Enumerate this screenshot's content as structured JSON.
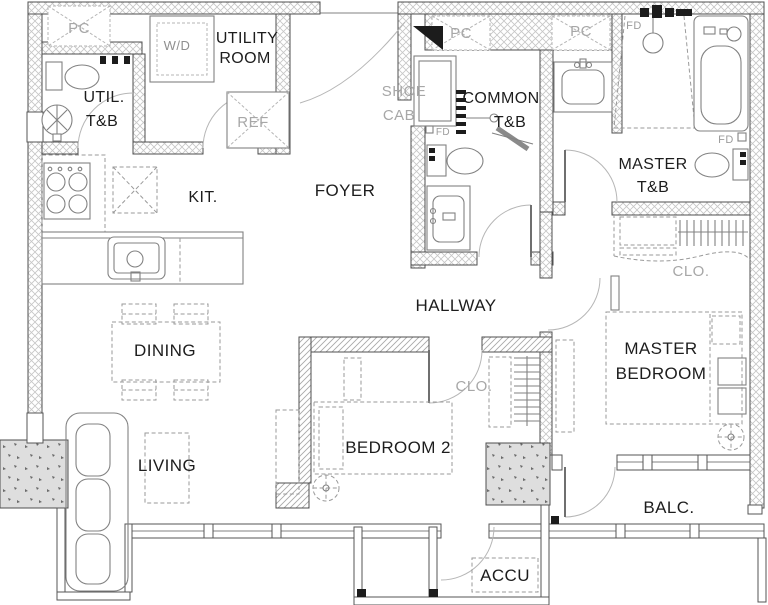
{
  "plan": {
    "rooms": {
      "utility_room": {
        "line1": "UTILITY",
        "line2": "ROOM"
      },
      "util_tb": {
        "line1": "UTIL.",
        "line2": "T&B"
      },
      "kitchen": {
        "label": "KIT."
      },
      "foyer": {
        "label": "FOYER"
      },
      "shoe_cab": {
        "line1": "SHOE",
        "line2": "CAB"
      },
      "common_tb": {
        "line1": "COMMON",
        "line2": "T&B"
      },
      "master_tb": {
        "line1": "MASTER",
        "line2": "T&B"
      },
      "hallway": {
        "label": "HALLWAY"
      },
      "dining": {
        "label": "DINING"
      },
      "living": {
        "label": "LIVING"
      },
      "bedroom2": {
        "label": "BEDROOM 2"
      },
      "master_bedroom": {
        "line1": "MASTER",
        "line2": "BEDROOM"
      },
      "closet_hall": {
        "label": "CLO."
      },
      "closet_master": {
        "label": "CLO."
      },
      "balcony": {
        "label": "BALC."
      },
      "accu": {
        "label": "ACCU"
      }
    },
    "annotations": {
      "pc_1": "PC",
      "pc_2": "PC",
      "pc_3": "PC",
      "washer_dryer": "W/D",
      "refrigerator": "REF",
      "floor_drain_common": "FD",
      "floor_drain_master_shower": "FD",
      "floor_drain_master_tub": "FD"
    },
    "colors": {
      "background": "#ffffff",
      "wall_outline": "#4f4f4f",
      "hatch_line": "#c6c6c6",
      "fixture_line": "#828282",
      "furniture_dash": "#9a9a9a",
      "label_dark": "#1d1d1d",
      "label_gray": "#a7a7a7",
      "door_leaf": "#1c1c1c"
    }
  }
}
